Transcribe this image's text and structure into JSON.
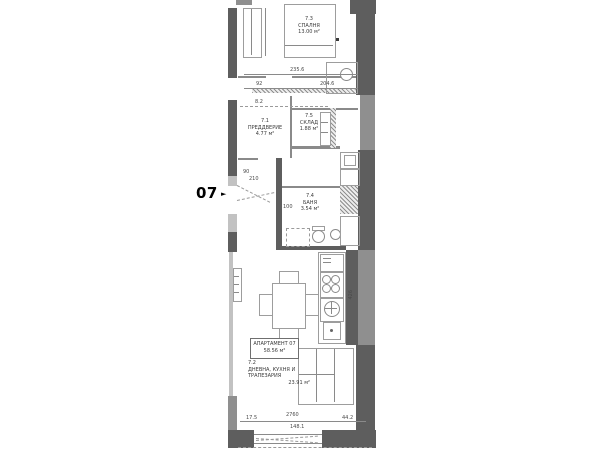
{
  "marker": {
    "number": "07",
    "arrow": "►"
  },
  "apartment_box": {
    "title": "АПАРТАМЕНТ 07",
    "area": "58.56 м²"
  },
  "rooms": {
    "bedroom": {
      "number": "7.3",
      "name": "СПАЛНЯ",
      "area": "13.00 м²"
    },
    "vestibule": {
      "number": "7.1",
      "name": "ПРЕДДВЕРИЕ",
      "area": "4.77 м²"
    },
    "storage": {
      "number": "7.5",
      "name": "СКЛАД",
      "area": "1.88 м²"
    },
    "bathroom": {
      "number": "7.4",
      "name": "БАНЯ",
      "area": "3.54 м²"
    },
    "living": {
      "number": "7.2",
      "name_line1": "ДНЕВНА, КУХНЯ И",
      "name_line2": "ТРАПЕЗАРИЯ",
      "area": "23.91 м²"
    }
  },
  "dimensions": {
    "bedroom_width": "235.6",
    "bedroom_width_inner": "204.6",
    "wall_offset": "92",
    "niche": "8.2",
    "door_width": "90",
    "door_height": "210",
    "corridor_width": "100",
    "kitchen_length": "426",
    "bottom_offset_left": "17.5",
    "terrace_width": "2760",
    "bottom_offset_right": "44.2",
    "window_width": "148.1"
  },
  "colors": {
    "wall_dark": "#5e5e5e",
    "wall_mid": "#8f8f8f",
    "wall_light": "#c2c2c2",
    "drawing_line": "#8a8a8a",
    "text": "#3a3a3a",
    "background": "#ffffff"
  }
}
